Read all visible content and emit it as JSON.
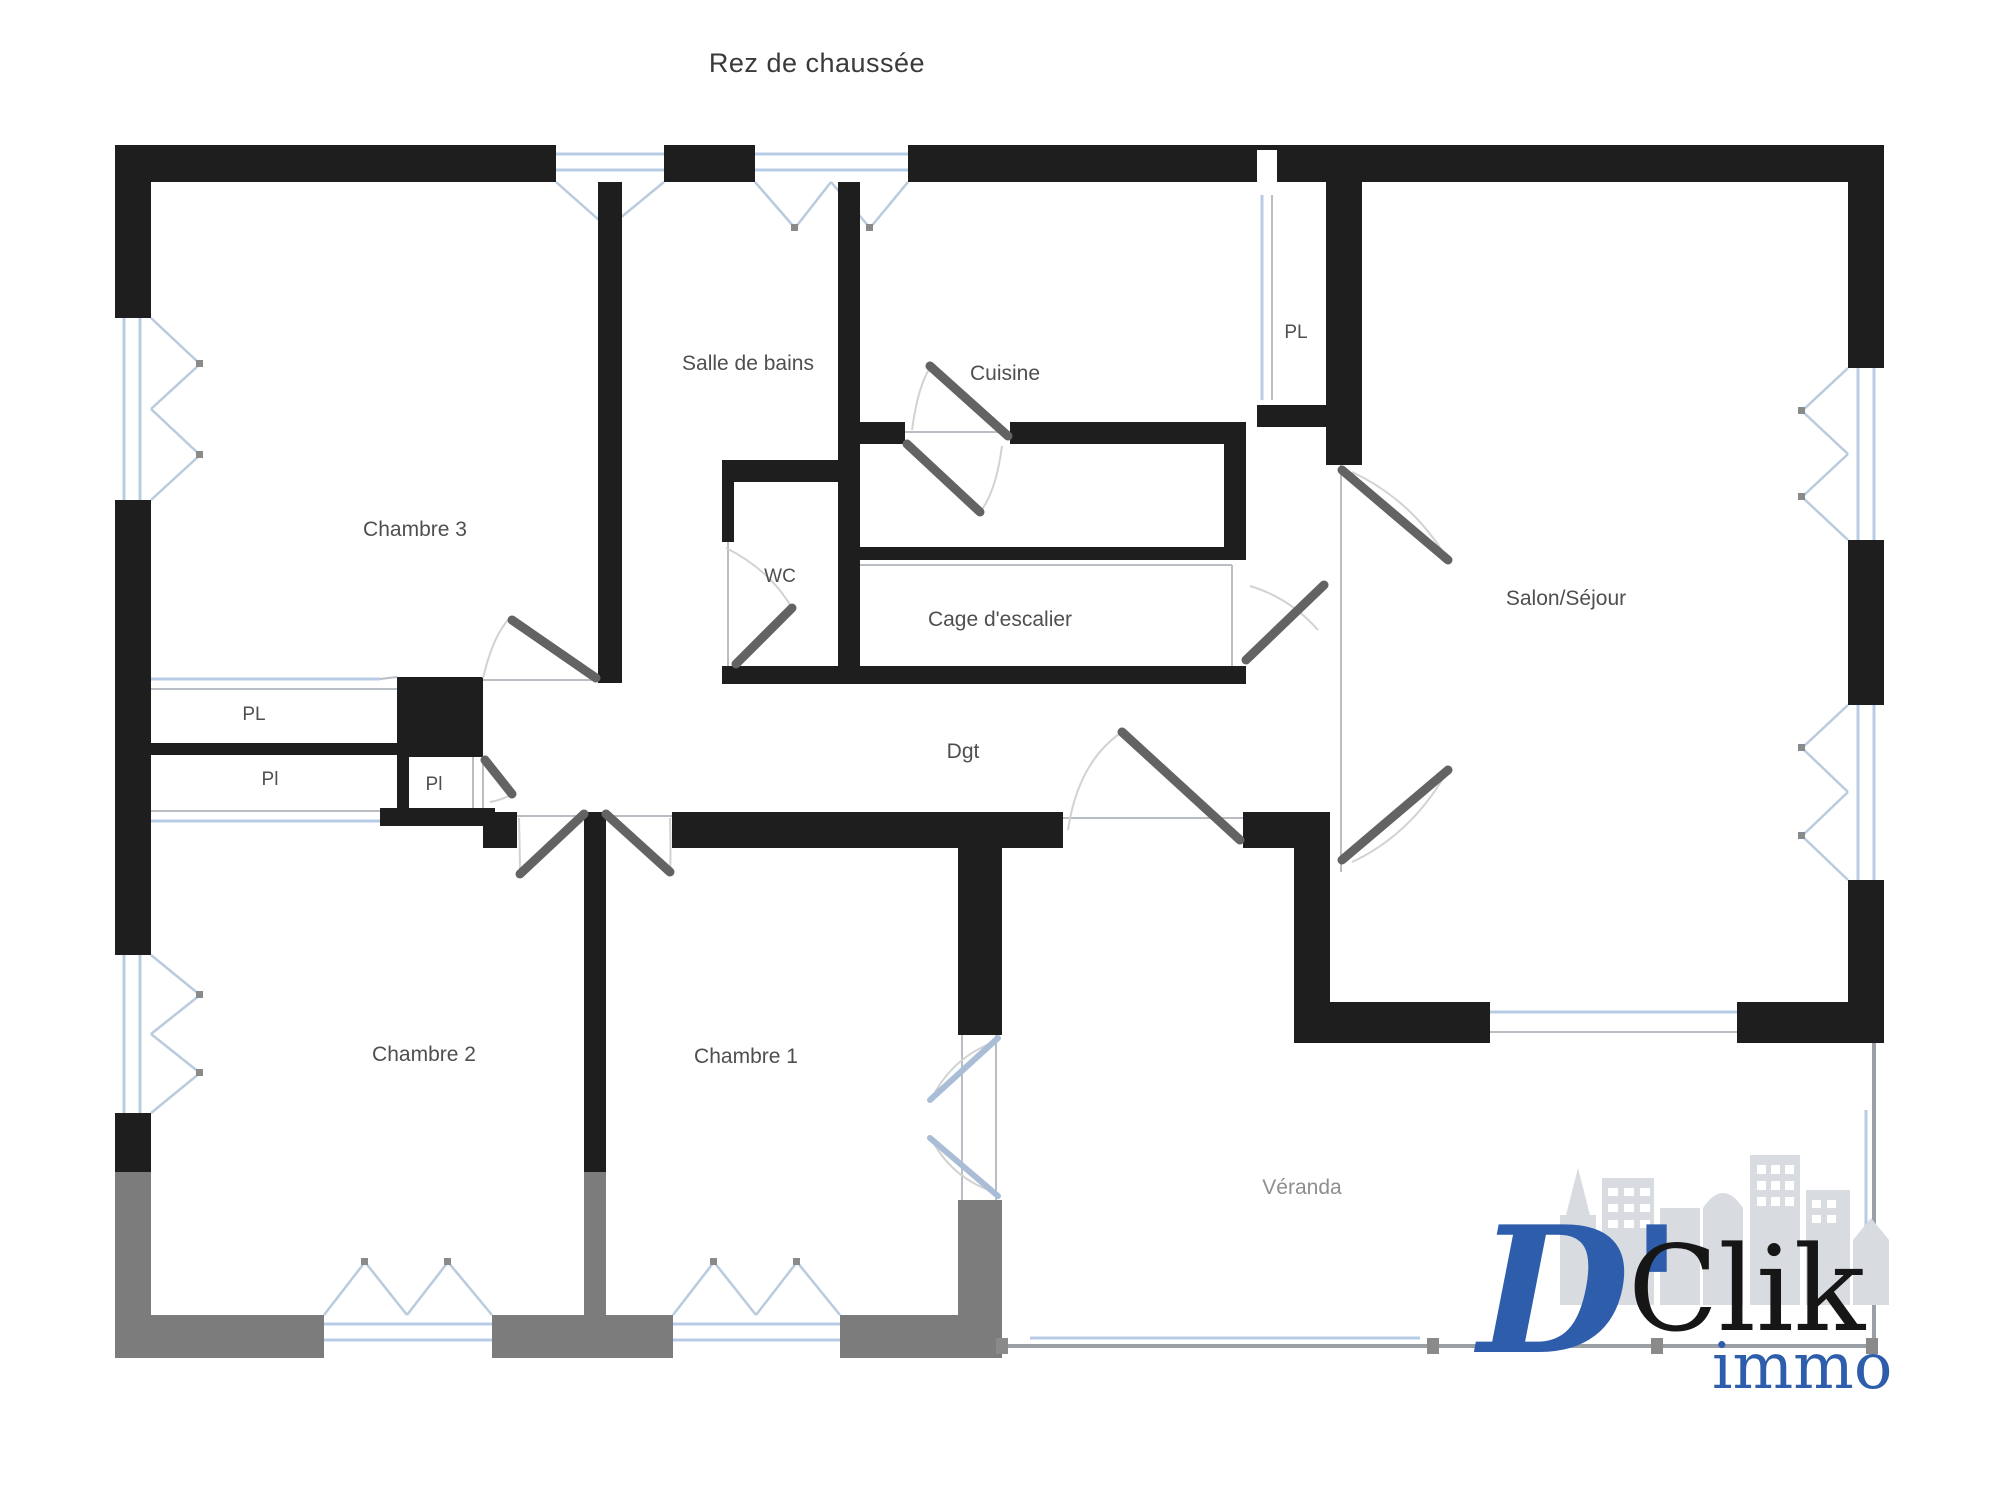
{
  "title": "Rez de chaussée",
  "rooms": {
    "chambre3": "Chambre 3",
    "salle_de_bains": "Salle de bains",
    "cuisine": "Cuisine",
    "pl_top": "PL",
    "salon": "Salon/Séjour",
    "wc": "WC",
    "cage": "Cage d'escalier",
    "dgt": "Dgt",
    "pl_left_1": "PL",
    "pl_left_2": "Pl",
    "pl_small": "Pl",
    "chambre2": "Chambre 2",
    "chambre1": "Chambre 1",
    "veranda": "Véranda"
  },
  "logo": {
    "d_part": "D'",
    "clik_part": "Clik",
    "immo_part": "immo"
  },
  "colors": {
    "wall": "#1e1e1e",
    "veranda_wall": "#7c7c7c",
    "window_blue": "#b7cce4",
    "door_leaf": "#636363",
    "veranda_door_leaf": "#a9bed6",
    "arc": "#d2d2d2",
    "label": "#4f4f4f",
    "veranda_label": "#8e8e8e",
    "logo_blue": "#2d5dab",
    "logo_black": "#161616",
    "skyline_gray": "#d8dbe0"
  }
}
